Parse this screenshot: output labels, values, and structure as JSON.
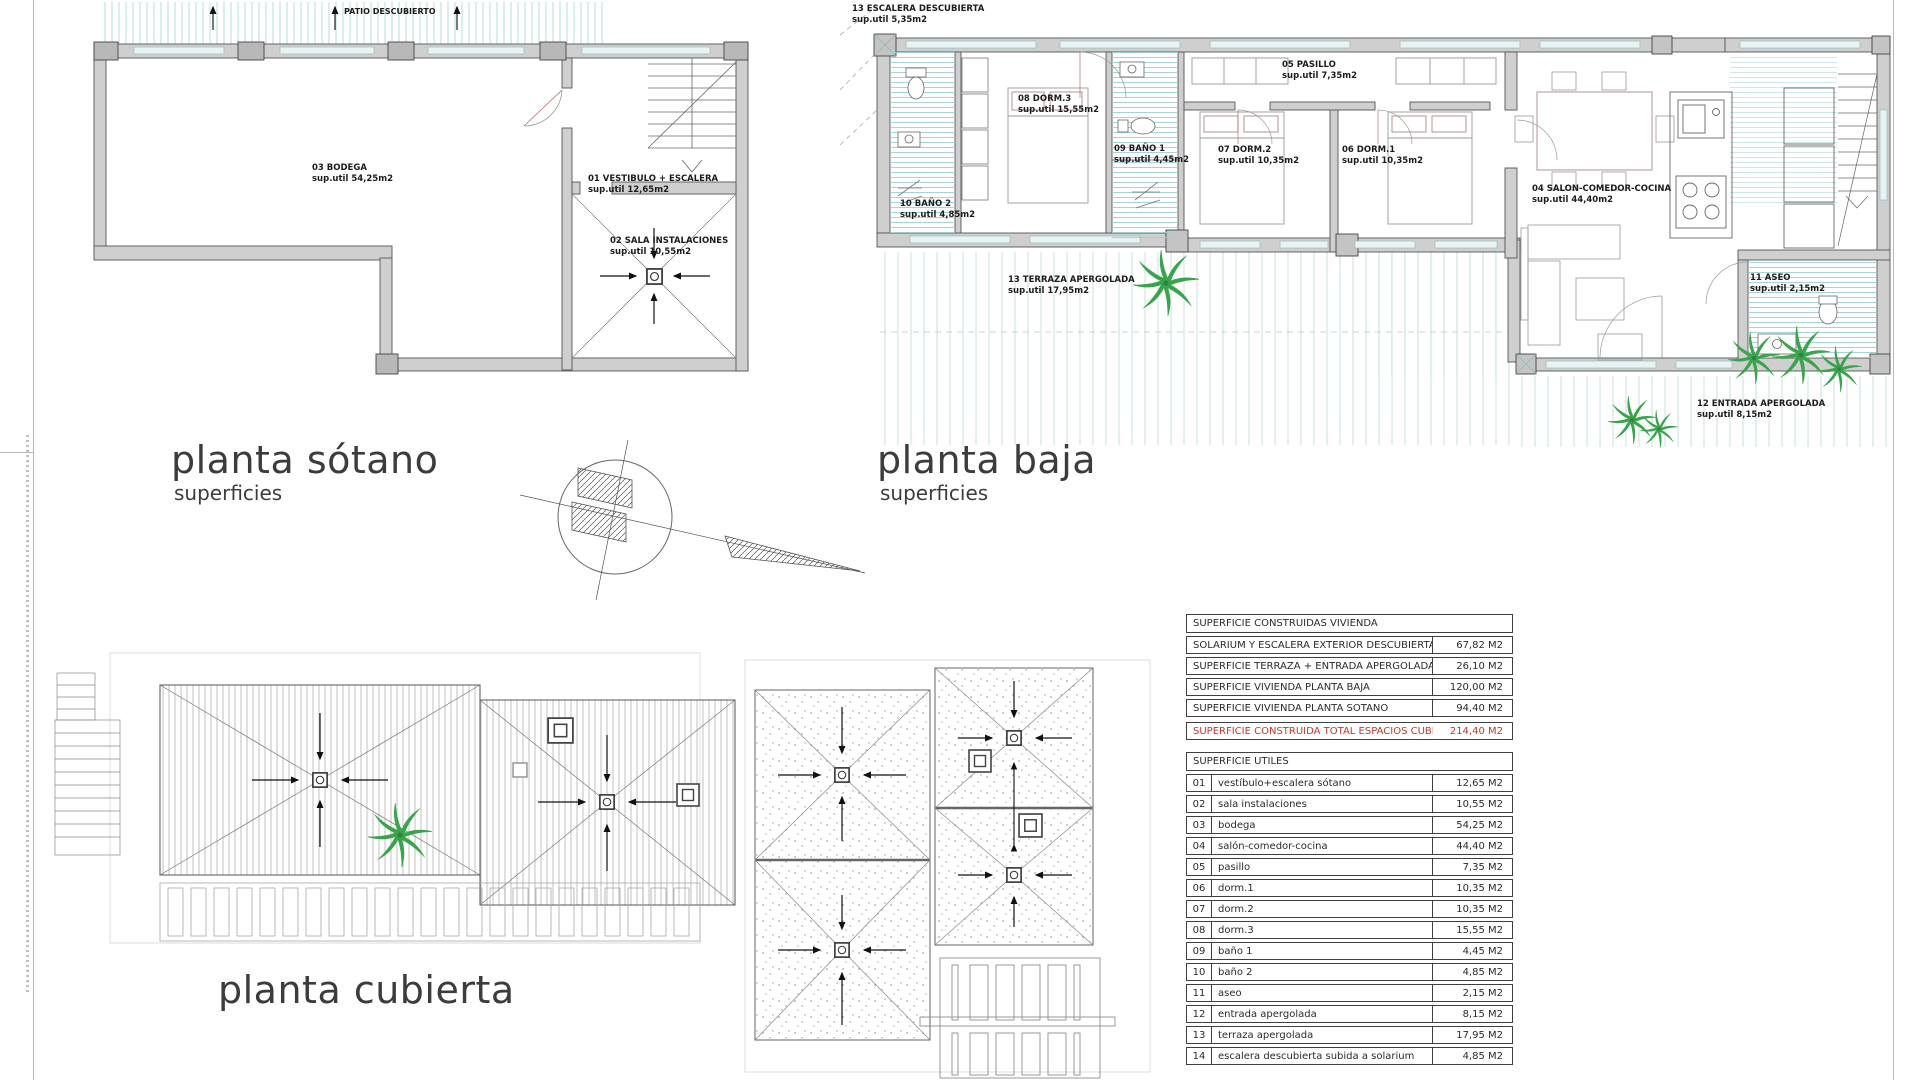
{
  "colors": {
    "accent_red": "#c4362a",
    "teal_hatch": "#9ccfcf",
    "wall_gray": "#cfcfcf",
    "palm_green": "#3aa44c"
  },
  "titles": {
    "sotano": {
      "title": "planta sótano",
      "subtitle": "superficies"
    },
    "baja": {
      "title": "planta baja",
      "subtitle": "superficies"
    },
    "cubierta": {
      "title": "planta cubierta"
    }
  },
  "plan_sotano": {
    "patio_label": "PATIO DESCUBIERTO",
    "rooms": {
      "bodega": {
        "name": "03 BODEGA",
        "area": "sup.util 54,25m2"
      },
      "vestibulo": {
        "name": "01 VESTIBULO + ESCALERA",
        "area": "sup.util 12,65m2"
      },
      "sala_instalaciones": {
        "name": "02 SALA INSTALACIONES",
        "area": "sup.util 10,55m2"
      }
    }
  },
  "plan_baja": {
    "rooms": {
      "escalera_descubierta": {
        "name": "13 ESCALERA DESCUBIERTA",
        "area": "sup.util 5,35m2"
      },
      "pasillo": {
        "name": "05 PASILLO",
        "area": "sup.util 7,35m2"
      },
      "dorm3": {
        "name": "08 DORM.3",
        "area": "sup.util 15,55m2"
      },
      "bano1": {
        "name": "09 BAÑO 1",
        "area": "sup.util 4,45m2"
      },
      "dorm2": {
        "name": "07 DORM.2",
        "area": "sup.util 10,35m2"
      },
      "dorm1": {
        "name": "06 DORM.1",
        "area": "sup.util 10,35m2"
      },
      "salon": {
        "name": "04 SALON-COMEDOR-COCINA",
        "area": "sup.util 44,40m2"
      },
      "bano2": {
        "name": "10 BAÑO 2",
        "area": "sup.util 4,85m2"
      },
      "terraza": {
        "name": "13 TERRAZA APERGOLADA",
        "area": "sup.util 17,95m2"
      },
      "aseo": {
        "name": "11 ASEO",
        "area": "sup.util 2,15m2"
      },
      "entrada": {
        "name": "12 ENTRADA APERGOLADA",
        "area": "sup.util 8,15m2"
      }
    }
  },
  "tables": {
    "construidas": {
      "header": "SUPERFICIE CONSTRUIDAS VIVIENDA",
      "rows": [
        {
          "label": "SOLARIUM Y ESCALERA EXTERIOR DESCUBIERTA",
          "value": "67,82 M2"
        },
        {
          "label": "SUPERFICIE TERRAZA + ENTRADA APERGOLADA",
          "value": "26,10 M2"
        },
        {
          "label": "SUPERFICIE VIVIENDA PLANTA BAJA",
          "value": "120,00 M2"
        },
        {
          "label": "SUPERFICIE VIVIENDA PLANTA SOTANO",
          "value": "94,40 M2"
        }
      ],
      "total": {
        "label": "SUPERFICIE CONSTRUIDA TOTAL ESPACIOS CUBIERTOS",
        "value": "214,40 M2"
      }
    },
    "utiles": {
      "header": "SUPERFICIE UTILES",
      "rows": [
        {
          "num": "01",
          "label": "vestíbulo+escalera sótano",
          "value": "12,65 M2"
        },
        {
          "num": "02",
          "label": "sala instalaciones",
          "value": "10,55 M2"
        },
        {
          "num": "03",
          "label": "bodega",
          "value": "54,25 M2"
        },
        {
          "num": "04",
          "label": "salón-comedor-cocina",
          "value": "44,40 M2"
        },
        {
          "num": "05",
          "label": "pasillo",
          "value": "7,35 M2"
        },
        {
          "num": "06",
          "label": "dorm.1",
          "value": "10,35 M2"
        },
        {
          "num": "07",
          "label": "dorm.2",
          "value": "10,35 M2"
        },
        {
          "num": "08",
          "label": "dorm.3",
          "value": "15,55 M2"
        },
        {
          "num": "09",
          "label": "baño 1",
          "value": "4,45 M2"
        },
        {
          "num": "10",
          "label": "baño 2",
          "value": "4,85 M2"
        },
        {
          "num": "11",
          "label": "aseo",
          "value": "2,15 M2"
        },
        {
          "num": "12",
          "label": "entrada apergolada",
          "value": "8,15 M2"
        },
        {
          "num": "13",
          "label": "terraza apergolada",
          "value": "17,95 M2"
        },
        {
          "num": "14",
          "label": "escalera descubierta subida a solarium",
          "value": "4,85 M2"
        }
      ]
    }
  }
}
